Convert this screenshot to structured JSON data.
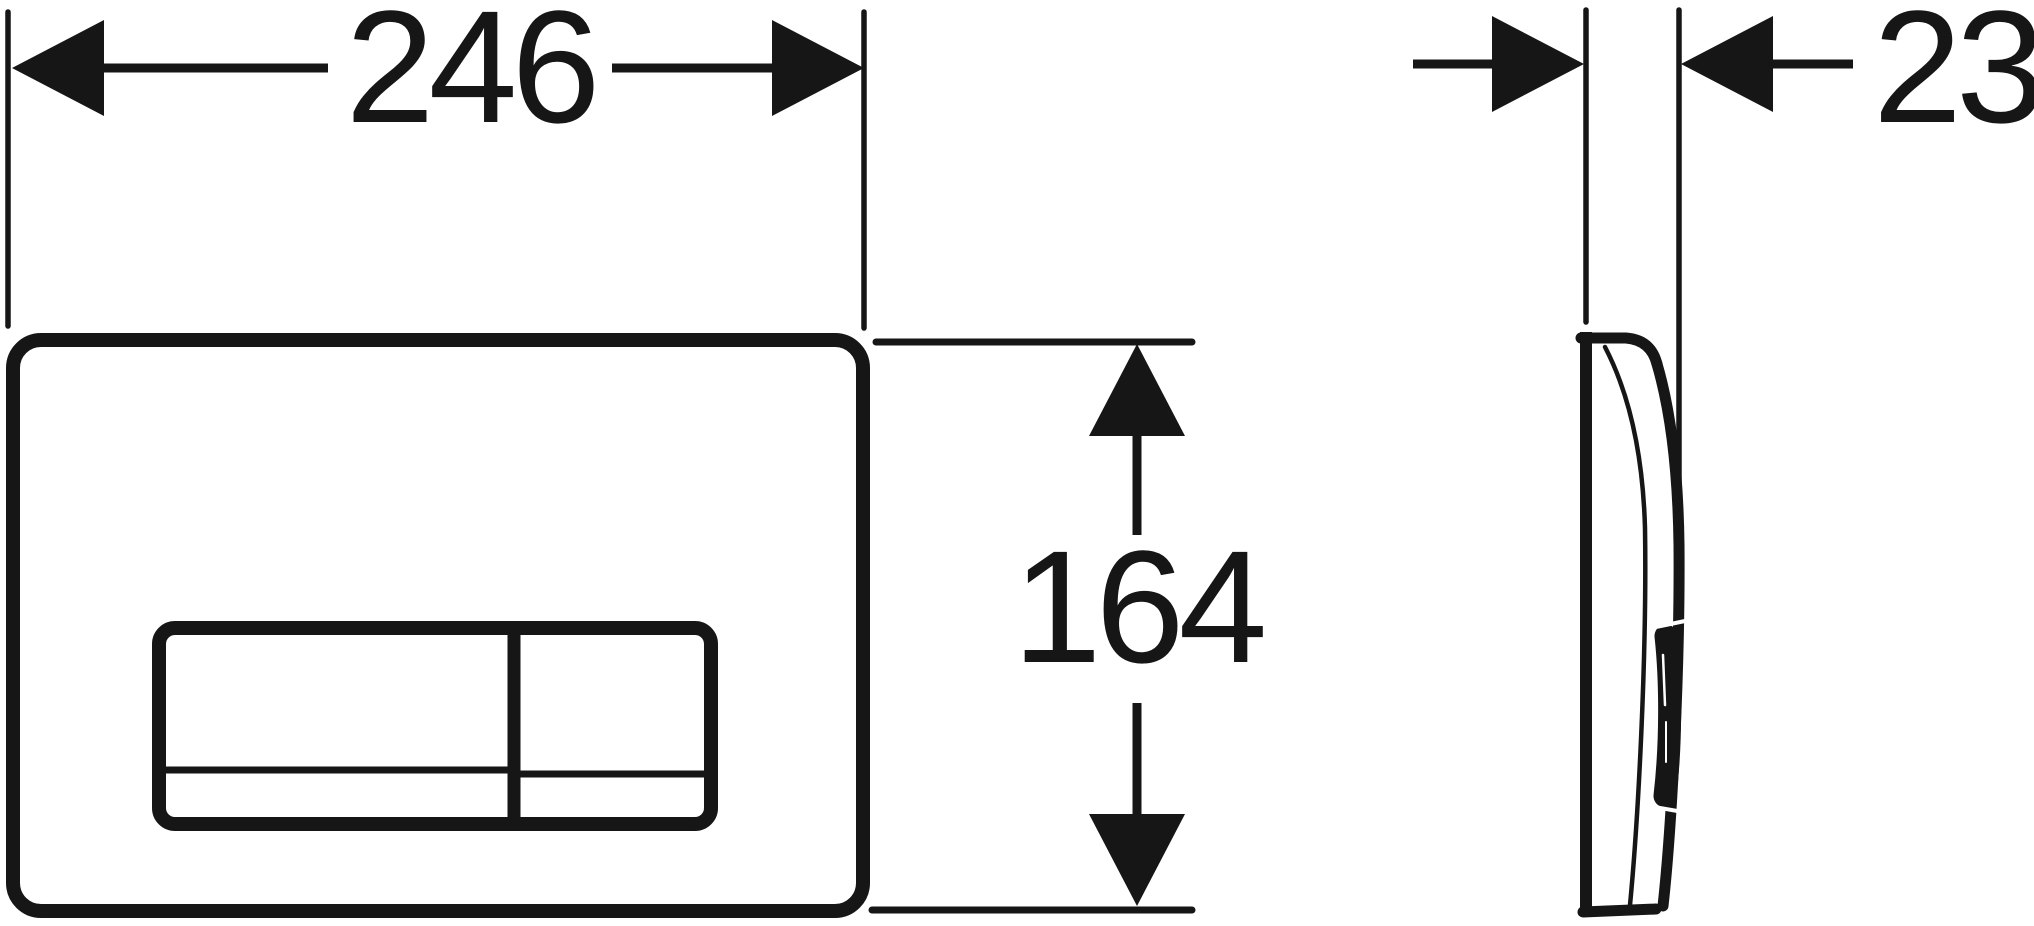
{
  "drawing": {
    "dimensions": {
      "width": {
        "label": "246"
      },
      "height": {
        "label": "164"
      },
      "depth": {
        "label": "23"
      }
    },
    "colors": {
      "line": "#161616",
      "background": "#ffffff"
    }
  }
}
